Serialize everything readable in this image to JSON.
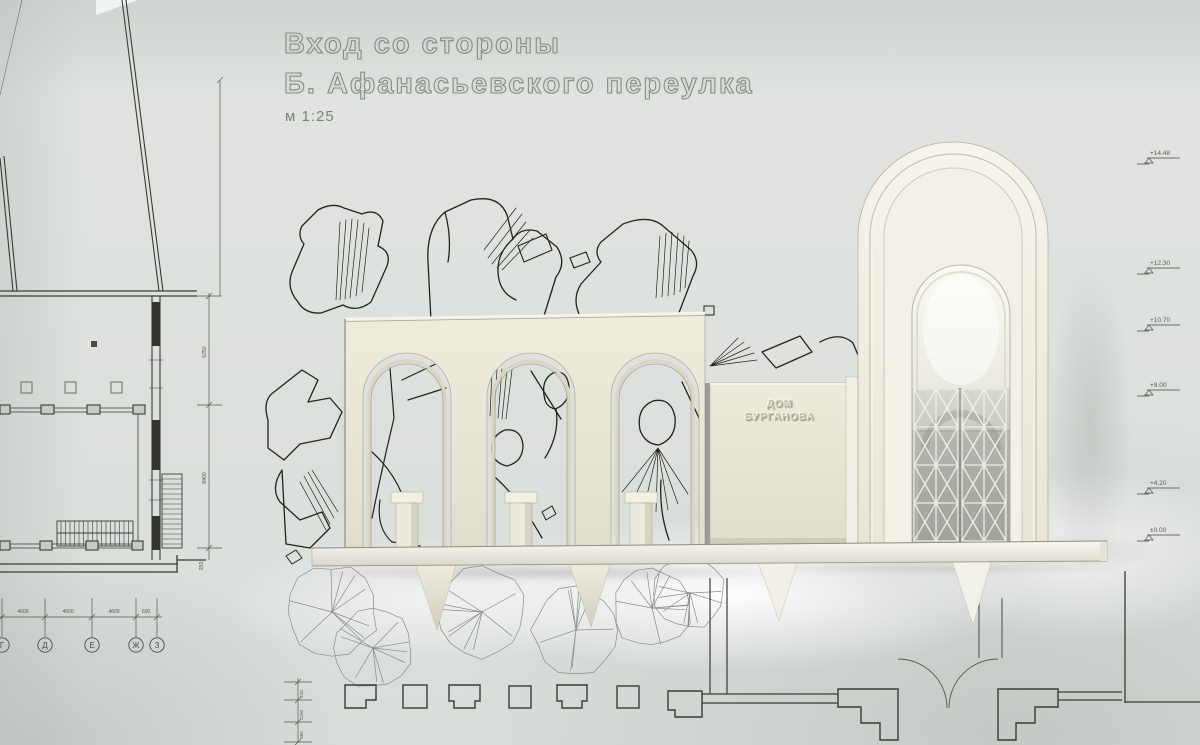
{
  "artwork": {
    "title_line1": "Вход со стороны",
    "title_line2": "Б. Афанасьевского переулка",
    "scale_label": "м 1:25"
  },
  "model_plaque": {
    "line1": "ДОМ",
    "line2": "БУРГАНОВА"
  },
  "elevation_marks": {
    "items": [
      {
        "label": "+14.48"
      },
      {
        "label": "+12.30"
      },
      {
        "label": "+10.70"
      },
      {
        "label": "+9.00"
      },
      {
        "label": "+4.20"
      },
      {
        "label": "±0.00"
      }
    ]
  },
  "plan": {
    "axis_bubbles": {
      "items": [
        {
          "label": "Г"
        },
        {
          "label": "Д"
        },
        {
          "label": "Е"
        },
        {
          "label": "Ж"
        },
        {
          "label": "З"
        }
      ]
    },
    "dim_segments": {
      "items": [
        {
          "label": "4600"
        },
        {
          "label": "4600"
        },
        {
          "label": "4600"
        },
        {
          "label": "600"
        }
      ]
    },
    "left_dims": {
      "items": [
        {
          "label": "6250"
        },
        {
          "label": "8400"
        },
        {
          "label": "250"
        }
      ]
    },
    "stack_dims": {
      "items": [
        {
          "label": "420"
        },
        {
          "label": "1250"
        },
        {
          "label": "350"
        }
      ]
    }
  },
  "colors": {
    "paper": "#dde0dc",
    "ink": "#3b3b37",
    "model_ivory": "#ece9da",
    "title_gray": "#878b86"
  }
}
